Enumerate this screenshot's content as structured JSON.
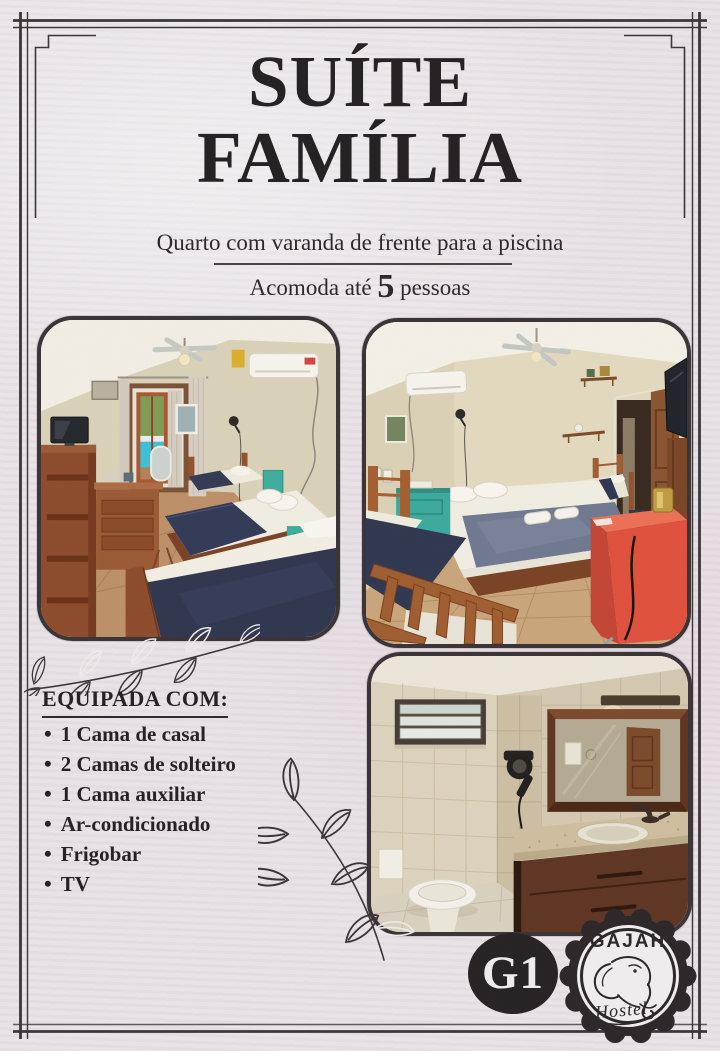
{
  "page": {
    "background": "#e9e3e6",
    "ink": "#272123",
    "border_color": "#3b3437"
  },
  "header": {
    "title_line1": "SUÍTE",
    "title_line2": "FAMÍLIA",
    "subtitle": "Quarto com varanda de frente para a piscina",
    "capacity_prefix": "Acomoda até ",
    "capacity_number": "5",
    "capacity_suffix": " pessoas"
  },
  "equipment": {
    "heading": "EQUIPADA COM:",
    "bullet": "•",
    "items": [
      "1 Cama de casal",
      "2 Camas de solteiro",
      "1 Cama auxiliar",
      "Ar-condicionado",
      "Frigobar",
      "TV"
    ]
  },
  "photos": [
    {
      "alt": "Bedroom with three beds and balcony door facing the pool"
    },
    {
      "alt": "Bedroom with beds, wooden furniture and red minibar"
    },
    {
      "alt": "Bathroom with shower window, vanity mirror and sink"
    }
  ],
  "badge": {
    "room_code": "G1"
  },
  "logo": {
    "brand": "GAJAH",
    "descriptor": "Hostel"
  },
  "accent_colors": {
    "navy_blanket": "#2f364e",
    "teal_nightstand": "#3bab9d",
    "red_minibar": "#e0503c",
    "pool": "#3fc0d4"
  }
}
